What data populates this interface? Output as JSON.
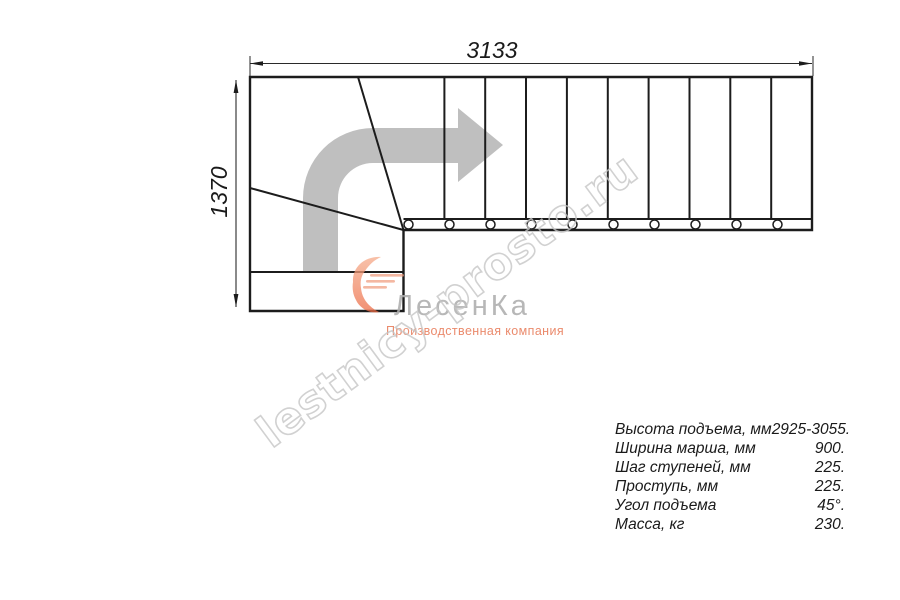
{
  "drawing": {
    "width_label": "3133",
    "height_label": "1370",
    "tread_count": 10,
    "baluster_count": 10
  },
  "watermark": {
    "text": "lestnicy-prosto.ru"
  },
  "logo": {
    "name": "ЛесенКа",
    "tagline": "Производственная компания",
    "swoosh_icon": "orange-swoosh-icon"
  },
  "specs": {
    "rows": [
      {
        "label": "Высота подъема, мм",
        "value": "2925-3055."
      },
      {
        "label": "Ширина марша, мм",
        "value": "900."
      },
      {
        "label": "Шаг ступеней, мм",
        "value": "225."
      },
      {
        "label": "Проступь, мм",
        "value": "225."
      },
      {
        "label": "Угол подъема",
        "value": "45°."
      },
      {
        "label": "Масса, кг",
        "value": "230."
      }
    ]
  },
  "colors": {
    "line": "#1c1c1c",
    "arrow_gray": "#bfbfbf",
    "watermark_gray": "#c6c6c6",
    "logo_gray": "#aeaeae",
    "logo_orange": "#e87a58",
    "background": "#ffffff"
  }
}
